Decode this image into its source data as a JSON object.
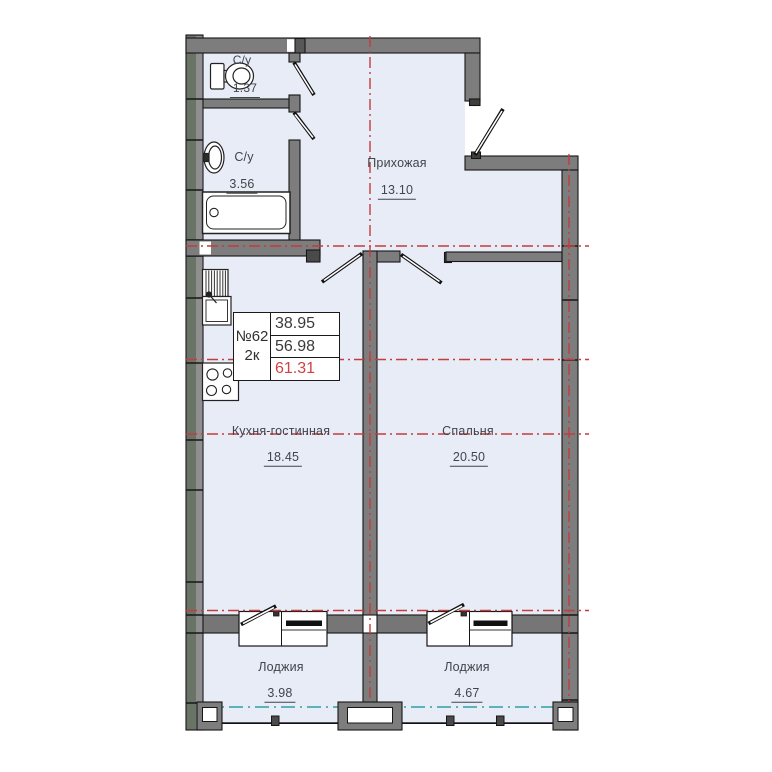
{
  "unit_card": {
    "number": "№62",
    "type": "2к",
    "areas": [
      "38.95",
      "56.98",
      "61.31"
    ]
  },
  "rooms": {
    "bathroom_small": {
      "label": "С/у",
      "area": "1.37"
    },
    "bathroom_large": {
      "label": "С/у",
      "area": "3.56"
    },
    "hallway": {
      "label": "Прихожая",
      "area": "13.10"
    },
    "kitchen_living": {
      "label": "Кухня-гостинная",
      "area": "18.45"
    },
    "bedroom": {
      "label": "Спальня",
      "area": "20.50"
    },
    "loggia_left": {
      "label": "Лоджия",
      "area": "3.98"
    },
    "loggia_right": {
      "label": "Лоджия",
      "area": "4.67"
    }
  },
  "colors": {
    "floor": "#e8ecf7",
    "interior_wall": "#7d7d7d",
    "exterior_wall": "#6a7466",
    "axis_red": "#c43c3c",
    "axis_teal": "#2fa0a6",
    "total_area_red": "#cf4343",
    "label_text": "#3f454a"
  }
}
